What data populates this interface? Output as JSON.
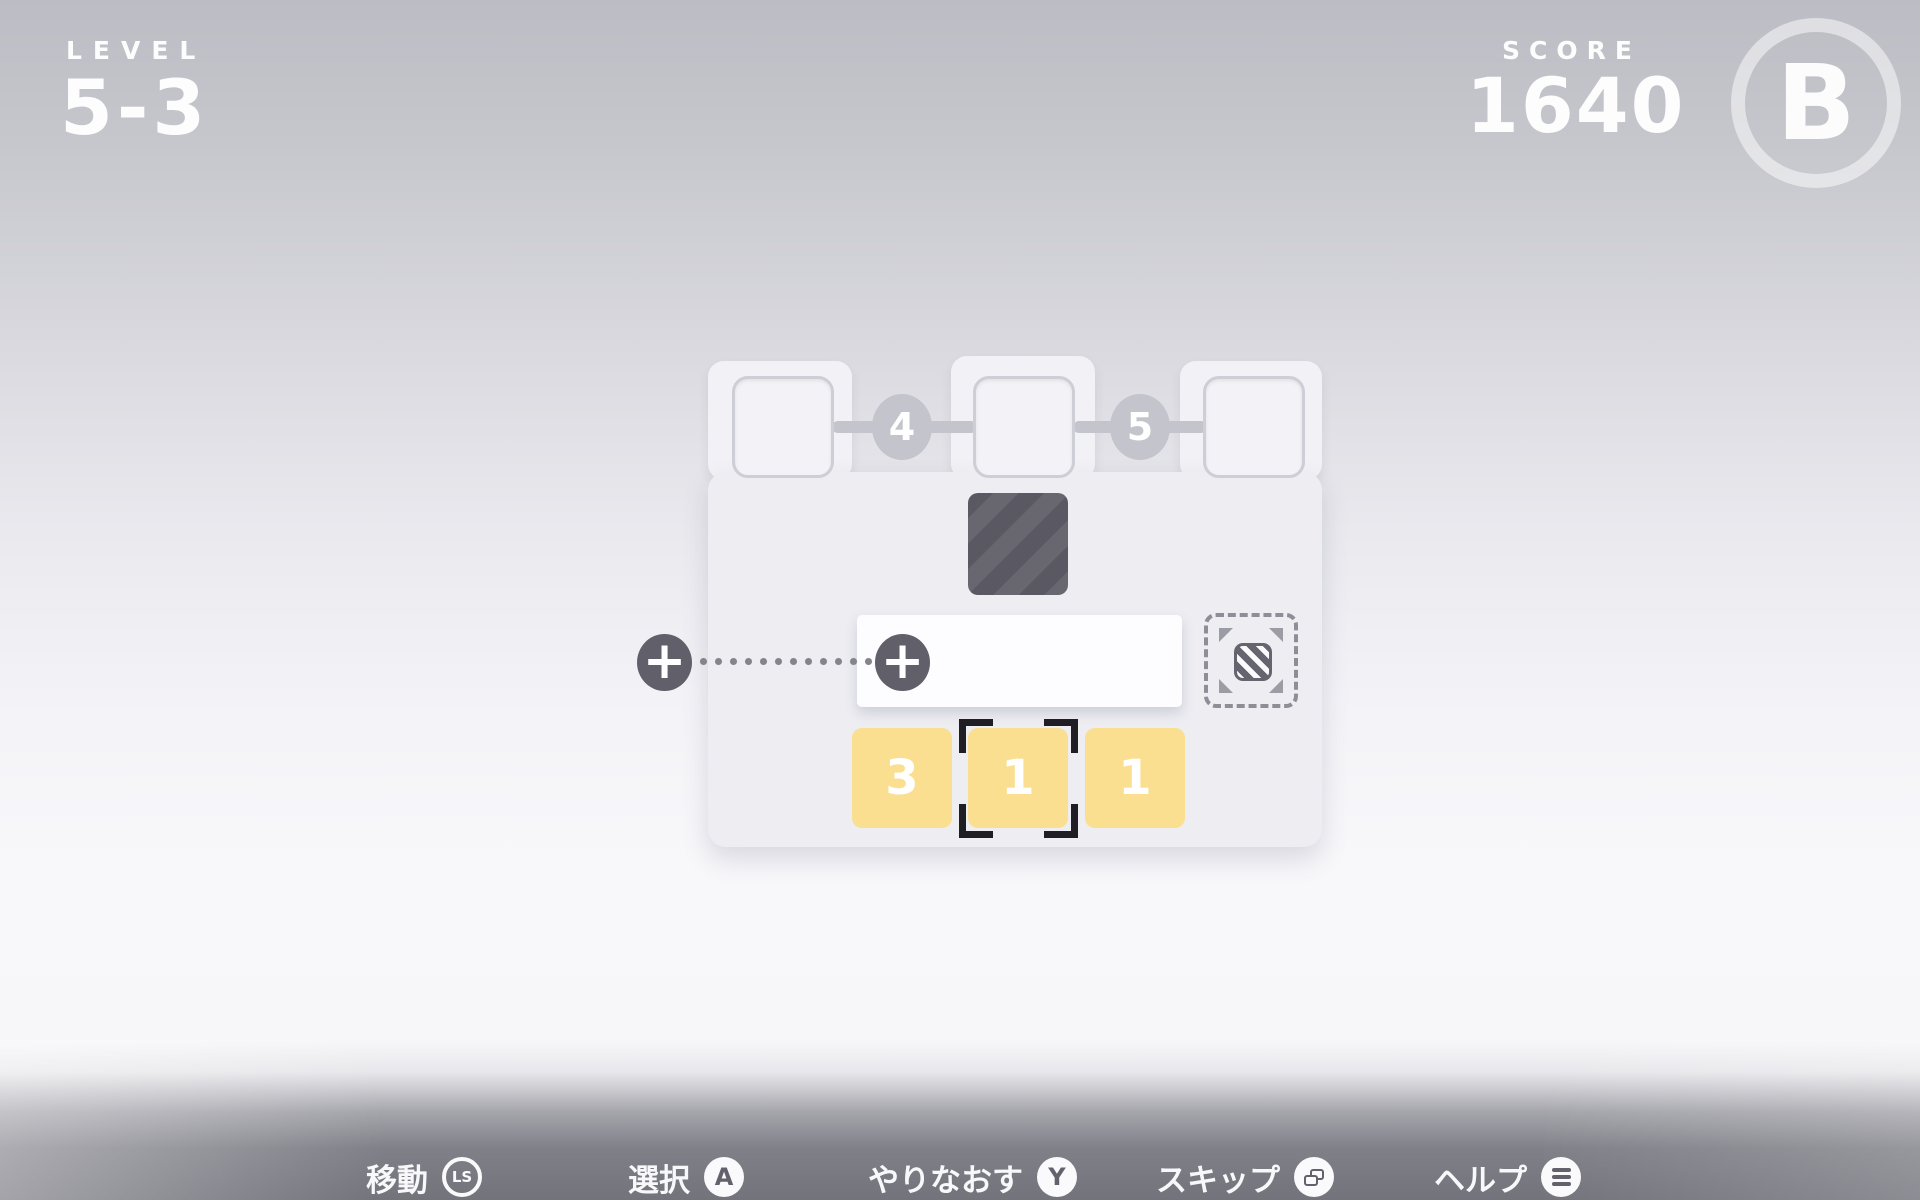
{
  "hud": {
    "level_label": "LEVEL",
    "level_value": "5-3",
    "score_label": "SCORE",
    "score_value": "1640",
    "rank": "B"
  },
  "board": {
    "progress_slots": [
      "",
      "",
      ""
    ],
    "connector_values": [
      "4",
      "5"
    ],
    "plus_sign": "+",
    "hand_tiles": [
      "3",
      "1",
      "1"
    ],
    "selected_tile_index": 1
  },
  "controls": [
    {
      "label": "移動",
      "button": "LS",
      "icon": "left-stick"
    },
    {
      "label": "選択",
      "button": "A",
      "icon": "button-a"
    },
    {
      "label": "やりなおす",
      "button": "Y",
      "icon": "button-y"
    },
    {
      "label": "スキップ",
      "button": "",
      "icon": "windows-stack"
    },
    {
      "label": "ヘルプ",
      "button": "",
      "icon": "menu-lines"
    }
  ],
  "colors": {
    "tile_yellow": "#fadf91",
    "tile_dark": "#5a5963",
    "node_gray": "#c3c4cc",
    "plus_circle": "#615f6a",
    "bracket": "#1e1e24"
  }
}
